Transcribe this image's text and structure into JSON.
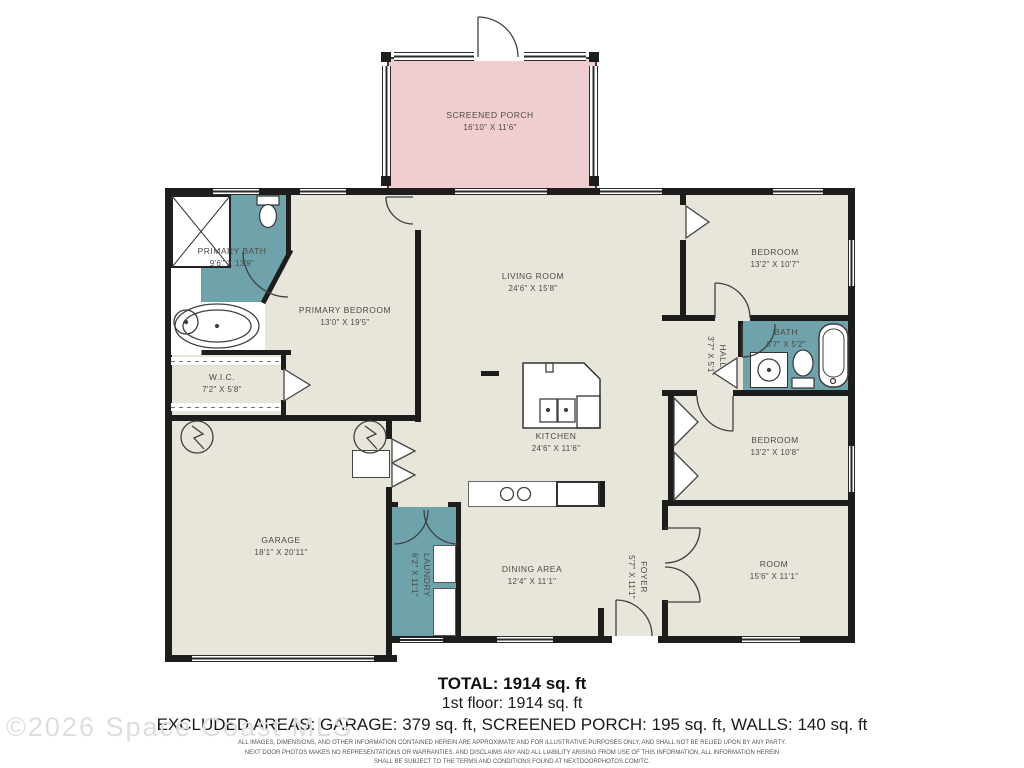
{
  "colors": {
    "room_fill": "#e8e6da",
    "porch_fill": "#f0cdd0",
    "wet_fill": "#6fa3ab",
    "wall": "#1d1d1b",
    "label_text": "#4b4b43"
  },
  "rooms": [
    {
      "id": "screened-porch",
      "name": "SCREENED PORCH",
      "dims": "16'10\" X 11'6\""
    },
    {
      "id": "primary-bath",
      "name": "PRIMARY BATH",
      "dims": "9'6\" X 13'9\""
    },
    {
      "id": "primary-bedroom",
      "name": "PRIMARY BEDROOM",
      "dims": "13'0\" X 19'5\""
    },
    {
      "id": "wic",
      "name": "W.I.C.",
      "dims": "7'2\" X 5'8\""
    },
    {
      "id": "living-room",
      "name": "LIVING ROOM",
      "dims": "24'6\" X 15'8\""
    },
    {
      "id": "kitchen",
      "name": "KITCHEN",
      "dims": "24'6\" X 11'6\""
    },
    {
      "id": "bedroom-1",
      "name": "BEDROOM",
      "dims": "13'2\" X 10'7\""
    },
    {
      "id": "hall",
      "name": "HALL",
      "dims": "3'7\" X 5'1\""
    },
    {
      "id": "bath",
      "name": "BATH",
      "dims": "8'7\" X 5'2\""
    },
    {
      "id": "bedroom-2",
      "name": "BEDROOM",
      "dims": "13'2\" X 10'8\""
    },
    {
      "id": "garage",
      "name": "GARAGE",
      "dims": "18'1\" X 20'11\""
    },
    {
      "id": "laundry",
      "name": "LAUNDRY",
      "dims": "6'2\" X 11'1\""
    },
    {
      "id": "dining-area",
      "name": "DINING AREA",
      "dims": "12'4\" X 11'1\""
    },
    {
      "id": "foyer",
      "name": "FOYER",
      "dims": "5'7\" X 11'1\""
    },
    {
      "id": "room",
      "name": "ROOM",
      "dims": "15'6\" X 11'1\""
    }
  ],
  "summary": {
    "total": "TOTAL: 1914 sq. ft",
    "first_floor": "1st floor: 1914 sq. ft",
    "excluded": "EXCLUDED AREAS: GARAGE: 379 sq. ft, SCREENED PORCH: 195 sq. ft, WALLS: 140 sq. ft"
  },
  "disclaimer": {
    "line1": "ALL IMAGES, DIMENSIONS, AND OTHER INFORMATION CONTAINED HEREIN ARE APPROXIMATE AND FOR ILLUSTRATIVE PURPOSES ONLY, AND SHALL NOT BE RELIED UPON BY ANY PARTY.",
    "line2": "NEXT DOOR PHOTOS MAKES NO REPRESENTATIONS OR WARRANTIES, AND DISCLAIMS ANY AND ALL LIABILITY ARISING FROM USE OF THIS INFORMATION. ALL INFORMATION HEREIN",
    "line3": "SHALL BE SUBJECT TO THE TERMS AND CONDITIONS FOUND AT NEXTDOORPHOTOS.COM/TC."
  },
  "watermark": "©2026 Space Coast MLS"
}
